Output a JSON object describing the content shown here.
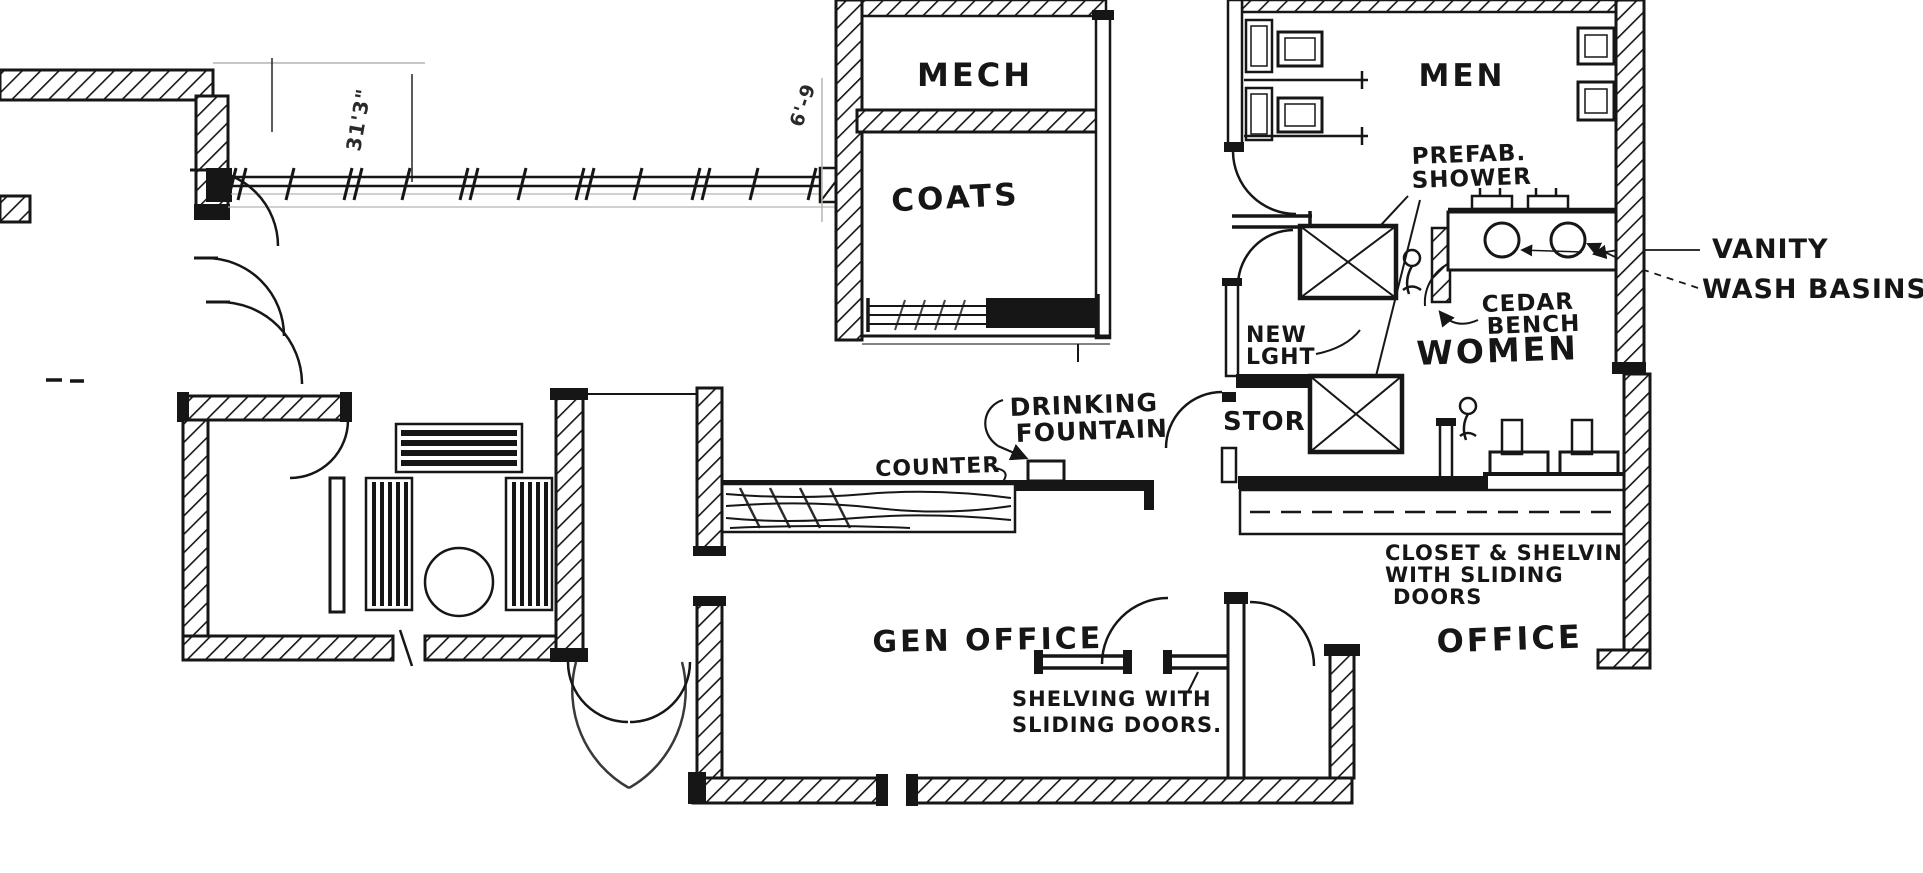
{
  "meta": {
    "drawing_type": "hand-drawn architectural floor plan sketch",
    "ink_color": "#161616",
    "paper_color": "#ffffff"
  },
  "rooms": {
    "mech": "MECH",
    "coats": "COATS",
    "men": "MEN",
    "women": "WOMEN",
    "stor": "STOR.",
    "gen_office": "GEN OFFICE",
    "office": "OFFICE"
  },
  "labels": {
    "prefab_line1": "PREFAB.",
    "prefab_line2": "SHOWER",
    "vanity": "VANITY",
    "wash_basins": "WASH BASINS",
    "cedar_line1": "CEDAR",
    "cedar_line2": "BENCH",
    "new_line1": "NEW",
    "new_line2": "LGHT",
    "drinking_line1": "DRINKING",
    "drinking_line2": "FOUNTAIN",
    "counter": "COUNTER",
    "closet_line1": "CLOSET & SHELVING",
    "closet_line2": "WITH SLIDING",
    "closet_line3": "DOORS",
    "shelving_line1": "SHELVING WITH",
    "shelving_line2": "SLIDING DOORS."
  },
  "dimensions": {
    "left_wing": "31'3\"",
    "mech_side": "6'-9"
  }
}
